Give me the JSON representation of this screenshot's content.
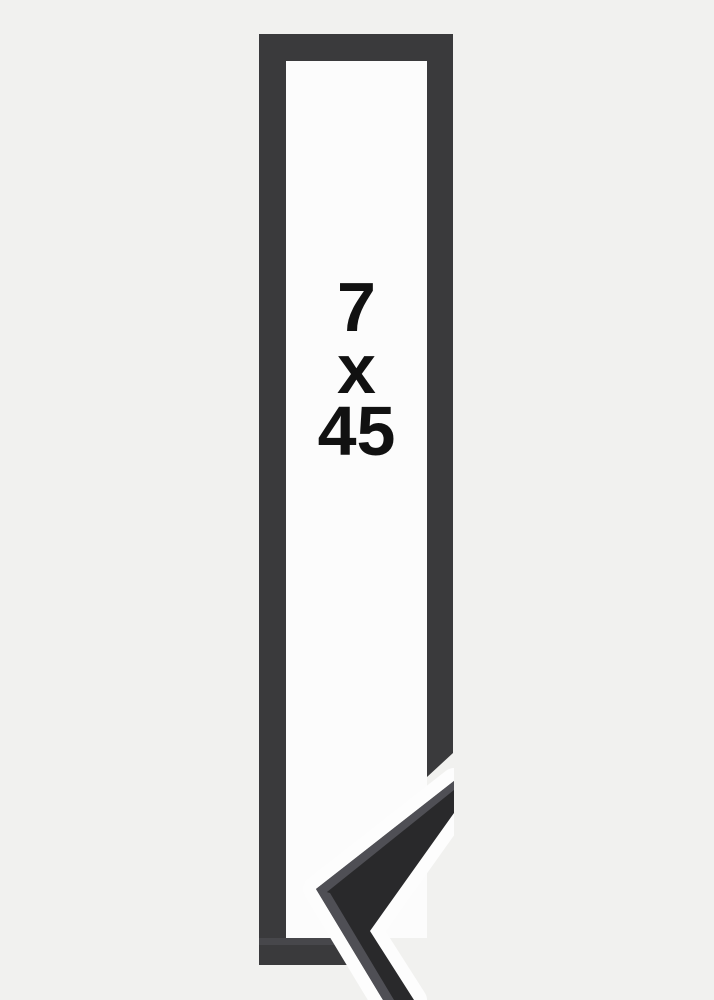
{
  "size_label": {
    "width": "7",
    "separator": "x",
    "height": "45"
  },
  "colors": {
    "background": "#f1f1ef",
    "frame": "#3a3a3c",
    "frame_top_face": "#47474b",
    "frame_interior": "#fcfcfc",
    "sample_face": "#29292b",
    "sample_bevel": "#4f4f55",
    "sample_gap": "#fdfdfd",
    "text": "#111111"
  }
}
